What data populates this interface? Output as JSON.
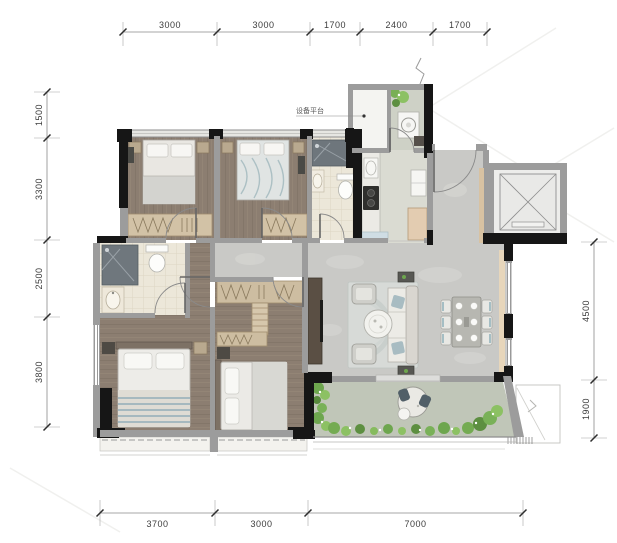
{
  "plan": {
    "equipment_platform_label": "设备平台"
  },
  "dimensions": {
    "top": [
      "3000",
      "3000",
      "1700",
      "2400",
      "1700"
    ],
    "left": [
      "1500",
      "3300",
      "2500",
      "3800"
    ],
    "right": [
      "4500",
      "1900"
    ],
    "bottom": [
      "3700",
      "3000",
      "7000"
    ]
  },
  "palette": {
    "wall_black": "#161616",
    "wall_gray": "#9c9c9c",
    "wood_floor": "#8c7e71",
    "tile_floor": "#ece7d9",
    "marble_floor": "#c9c9c6",
    "kitchen_floor": "#dadbd2",
    "balcony_floor": "#c0c6b8",
    "plant_green": "#74ab52",
    "accent_teal": "#8fb0ba",
    "wood_trim": "#d8c2a2",
    "dim_text": "#3c3c3c"
  }
}
